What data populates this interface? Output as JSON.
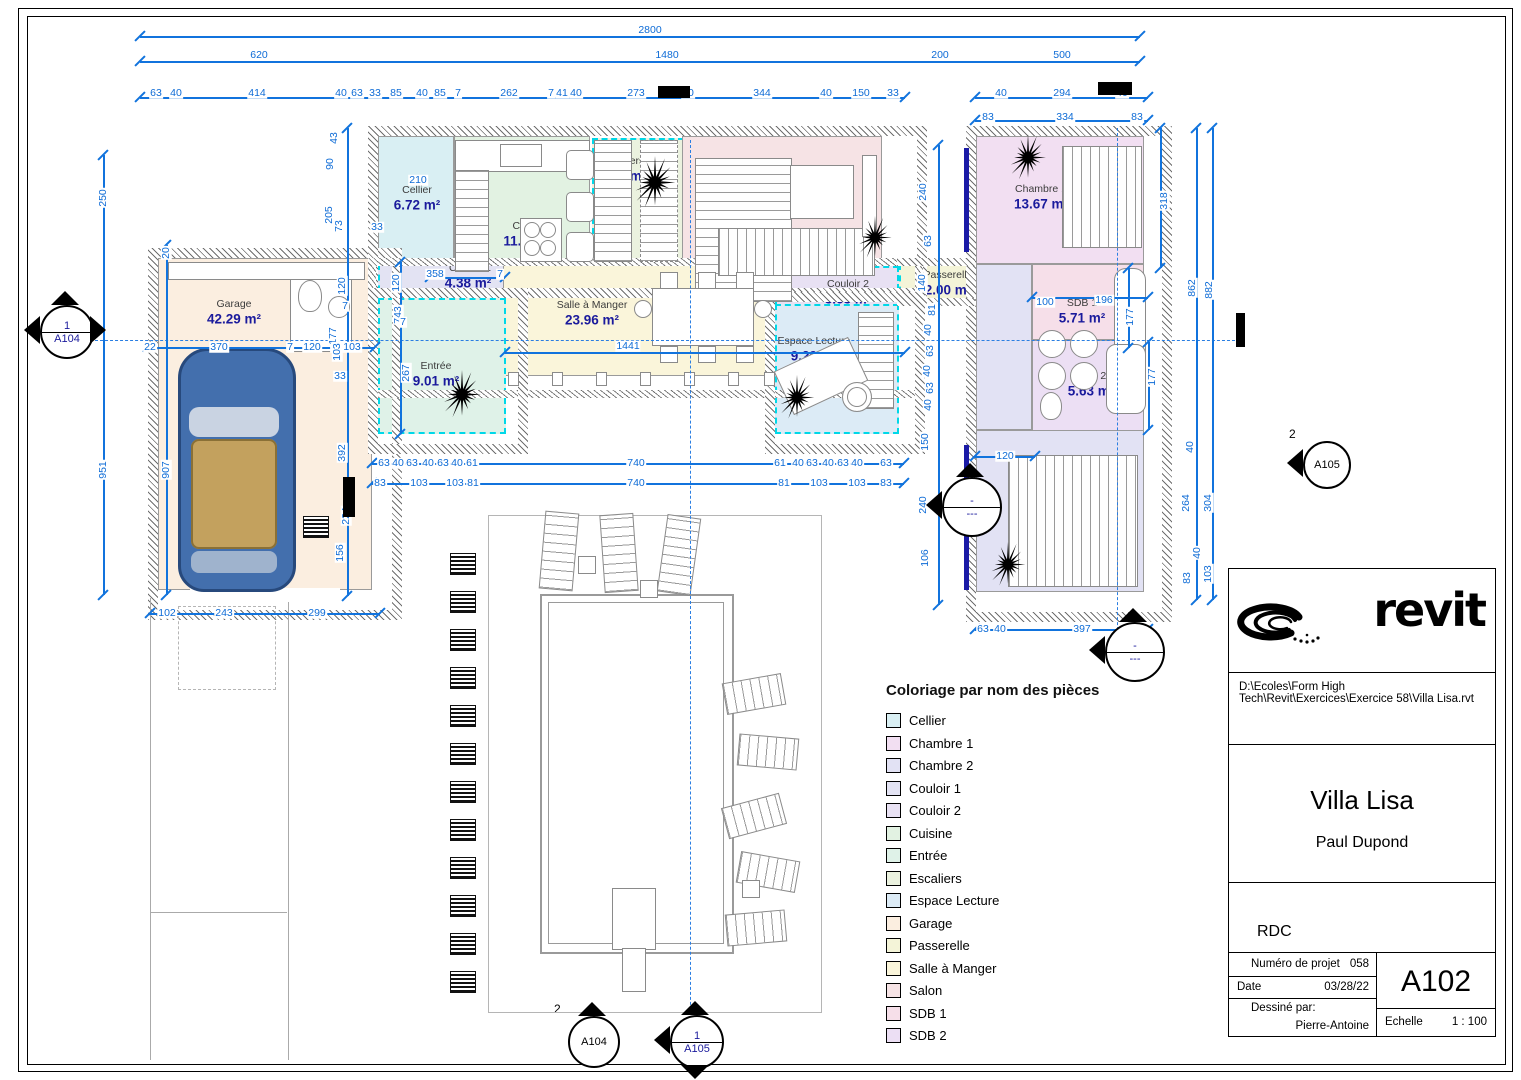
{
  "title_block": {
    "logo_text": "revit",
    "file_path": "D:\\Ecoles\\Form High Tech\\Revit\\Exercices\\Exercice 58\\Villa Lisa.rvt",
    "project_name": "Villa Lisa",
    "author": "Paul Dupond",
    "view_name": "RDC",
    "project_number_label": "Numéro de projet",
    "project_number": "058",
    "date_label": "Date",
    "date": "03/28/22",
    "drawn_by_label": "Dessiné par:",
    "drawn_by": "Pierre-Antoine",
    "sheet_number": "A102",
    "scale_label": "Echelle",
    "scale_value": "1 : 100"
  },
  "legend": {
    "title": "Coloriage par nom des pièces",
    "items": [
      {
        "label": "Cellier",
        "color": "#d9eff3"
      },
      {
        "label": "Chambre 1",
        "color": "#f2dff2"
      },
      {
        "label": "Chambre 2",
        "color": "#e2e2f4"
      },
      {
        "label": "Couloir 1",
        "color": "#e3e3f3"
      },
      {
        "label": "Couloir 2",
        "color": "#e8e1f3"
      },
      {
        "label": "Cuisine",
        "color": "#e2f2e2"
      },
      {
        "label": "Entrée",
        "color": "#dff2e8"
      },
      {
        "label": "Escaliers",
        "color": "#ebf2df"
      },
      {
        "label": "Espace Lecture",
        "color": "#dcebf6"
      },
      {
        "label": "Garage",
        "color": "#fbeee0"
      },
      {
        "label": "Passerelle",
        "color": "#f4f4d8"
      },
      {
        "label": "Salle à Manger",
        "color": "#faf5da"
      },
      {
        "label": "Salon",
        "color": "#f6e3e5"
      },
      {
        "label": "SDB 1",
        "color": "#f6dfe9"
      },
      {
        "label": "SDB 2",
        "color": "#ecdff4"
      }
    ]
  },
  "plan": {
    "haut_label": "HAUT",
    "rooms": [
      {
        "name": "Garage",
        "area": "42.29 m²",
        "color": "#fbeee0",
        "dashed": false
      },
      {
        "name": "Cellier",
        "area": "6.72 m²",
        "color": "#d9eff3",
        "dashed": false
      },
      {
        "name": "Cuisine",
        "area": "11.67 m²",
        "color": "#e2f2e2",
        "dashed": false
      },
      {
        "name": "Escaliers",
        "area": "8.03 m²",
        "color": "#ebf2df",
        "dashed": true
      },
      {
        "name": "Salon",
        "area": "20.39 m²",
        "color": "#f6e3e5",
        "dashed": false
      },
      {
        "name": "Couloir 1",
        "area": "4.38 m²",
        "color": "#e3e3f3",
        "dashed": true
      },
      {
        "name": "Salle à Manger",
        "area": "23.96 m²",
        "color": "#faf5da",
        "dashed": false
      },
      {
        "name": "Couloir 2",
        "area": "3.63 m²",
        "color": "#e8e1f3",
        "dashed": true
      },
      {
        "name": "Espace Lecture",
        "area": "9.29 m²",
        "color": "#dcebf6",
        "dashed": true
      },
      {
        "name": "Entrée",
        "area": "9.01 m²",
        "color": "#dff2e8",
        "dashed": true
      },
      {
        "name": "Passerelle",
        "area": "2.00 m²",
        "color": "#f4f4d8",
        "dashed": true
      },
      {
        "name": "Chambre 1",
        "area": "13.67 m²",
        "color": "#f2dff2",
        "dashed": false
      },
      {
        "name": "SDB 1",
        "area": "5.71 m²",
        "color": "#f6dfe9",
        "dashed": false
      },
      {
        "name": "SDB 2",
        "area": "5.63 m²",
        "color": "#ecdff4",
        "dashed": false
      },
      {
        "name": "Chambre 2",
        "area": "21.94 m²",
        "color": "#e2e2f4",
        "dashed": false
      }
    ],
    "dims": [
      [
        "2800",
        650,
        30,
        0
      ],
      [
        "620",
        259,
        55,
        0
      ],
      [
        "1480",
        667,
        55,
        0
      ],
      [
        "200",
        940,
        55,
        0
      ],
      [
        "500",
        1062,
        55,
        0
      ],
      [
        "63",
        156,
        93,
        0
      ],
      [
        "40",
        176,
        93,
        0
      ],
      [
        "414",
        257,
        93,
        0
      ],
      [
        "40",
        341,
        93,
        0
      ],
      [
        "63",
        357,
        93,
        0
      ],
      [
        "33",
        375,
        93,
        0
      ],
      [
        "85",
        396,
        93,
        0
      ],
      [
        "40",
        422,
        93,
        0
      ],
      [
        "85",
        440,
        93,
        0
      ],
      [
        "7",
        458,
        93,
        0
      ],
      [
        "262",
        509,
        93,
        0
      ],
      [
        "7",
        551,
        93,
        0
      ],
      [
        "41",
        562,
        93,
        0
      ],
      [
        "40",
        576,
        93,
        0
      ],
      [
        "273",
        636,
        93,
        0
      ],
      [
        "40",
        688,
        93,
        0
      ],
      [
        "344",
        762,
        93,
        0
      ],
      [
        "40",
        826,
        93,
        0
      ],
      [
        "150",
        861,
        93,
        0
      ],
      [
        "33",
        893,
        93,
        0
      ],
      [
        "40",
        1001,
        93,
        0
      ],
      [
        "294",
        1062,
        93,
        0
      ],
      [
        "40",
        1122,
        93,
        0
      ],
      [
        "83",
        988,
        117,
        0
      ],
      [
        "334",
        1065,
        117,
        0
      ],
      [
        "83",
        1137,
        117,
        0
      ],
      [
        "250",
        103,
        198,
        1
      ],
      [
        "951",
        103,
        470,
        1
      ],
      [
        "20",
        166,
        253,
        1
      ],
      [
        "907",
        166,
        470,
        1
      ],
      [
        "22",
        150,
        347,
        0
      ],
      [
        "370",
        219,
        347,
        0
      ],
      [
        "7",
        290,
        347,
        0
      ],
      [
        "120",
        312,
        347,
        0
      ],
      [
        "7",
        334,
        347,
        0
      ],
      [
        "103",
        352,
        347,
        0
      ],
      [
        "102",
        167,
        613,
        0
      ],
      [
        "243",
        224,
        613,
        0
      ],
      [
        "299",
        317,
        613,
        0
      ],
      [
        "43",
        334,
        138,
        1
      ],
      [
        "90",
        330,
        164,
        1
      ],
      [
        "205",
        329,
        215,
        1
      ],
      [
        "73",
        339,
        226,
        1
      ],
      [
        "33",
        377,
        227,
        0
      ],
      [
        "120",
        342,
        286,
        1
      ],
      [
        "120",
        396,
        283,
        1
      ],
      [
        "7",
        345,
        306,
        0
      ],
      [
        "743",
        398,
        315,
        1
      ],
      [
        "7",
        403,
        322,
        0
      ],
      [
        "177",
        333,
        336,
        1
      ],
      [
        "103",
        337,
        352,
        1
      ],
      [
        "33",
        340,
        376,
        0
      ],
      [
        "267",
        406,
        373,
        1
      ],
      [
        "392",
        342,
        453,
        1
      ],
      [
        "224",
        346,
        516,
        1
      ],
      [
        "156",
        340,
        553,
        1
      ],
      [
        "210",
        418,
        180,
        0
      ],
      [
        "358",
        435,
        274,
        0
      ],
      [
        "7",
        500,
        274,
        0
      ],
      [
        "1441",
        628,
        346,
        0
      ],
      [
        "63",
        384,
        463,
        0
      ],
      [
        "40",
        398,
        463,
        0
      ],
      [
        "63",
        412,
        463,
        0
      ],
      [
        "40",
        428,
        463,
        0
      ],
      [
        "63",
        443,
        463,
        0
      ],
      [
        "40",
        457,
        463,
        0
      ],
      [
        "61",
        472,
        463,
        0
      ],
      [
        "740",
        636,
        463,
        0
      ],
      [
        "61",
        780,
        463,
        0
      ],
      [
        "40",
        798,
        463,
        0
      ],
      [
        "63",
        812,
        463,
        0
      ],
      [
        "40",
        828,
        463,
        0
      ],
      [
        "63",
        843,
        463,
        0
      ],
      [
        "40",
        857,
        463,
        0
      ],
      [
        "63",
        886,
        463,
        0
      ],
      [
        "83",
        380,
        483,
        0
      ],
      [
        "103",
        419,
        483,
        0
      ],
      [
        "103",
        455,
        483,
        0
      ],
      [
        "81",
        473,
        483,
        0
      ],
      [
        "740",
        636,
        483,
        0
      ],
      [
        "81",
        784,
        483,
        0
      ],
      [
        "103",
        819,
        483,
        0
      ],
      [
        "103",
        857,
        483,
        0
      ],
      [
        "83",
        886,
        483,
        0
      ],
      [
        "240",
        923,
        192,
        1
      ],
      [
        "63",
        928,
        241,
        1
      ],
      [
        "140",
        922,
        283,
        1
      ],
      [
        "81",
        932,
        310,
        1
      ],
      [
        "40",
        928,
        330,
        1
      ],
      [
        "63",
        930,
        351,
        1
      ],
      [
        "40",
        927,
        371,
        1
      ],
      [
        "63",
        930,
        388,
        1
      ],
      [
        "40",
        928,
        405,
        1
      ],
      [
        "150",
        925,
        442,
        1
      ],
      [
        "240",
        923,
        505,
        1
      ],
      [
        "106",
        925,
        558,
        1
      ],
      [
        "318",
        1164,
        201,
        1
      ],
      [
        "862",
        1192,
        288,
        1
      ],
      [
        "882",
        1209,
        290,
        1
      ],
      [
        "100",
        1045,
        302,
        0
      ],
      [
        "196",
        1104,
        300,
        0
      ],
      [
        "177",
        1130,
        317,
        1
      ],
      [
        "177",
        1152,
        377,
        1
      ],
      [
        "120",
        1005,
        456,
        0
      ],
      [
        "40",
        1190,
        447,
        1
      ],
      [
        "264",
        1186,
        503,
        1
      ],
      [
        "304",
        1208,
        503,
        1
      ],
      [
        "40",
        1197,
        553,
        1
      ],
      [
        "83",
        1187,
        578,
        1
      ],
      [
        "103",
        1208,
        574,
        1
      ],
      [
        "63",
        983,
        629,
        0
      ],
      [
        "40",
        1000,
        629,
        0
      ],
      [
        "397",
        1082,
        629,
        0
      ]
    ],
    "markers": [
      {
        "top": "1",
        "bottom": "A104",
        "x": 65,
        "y": 330,
        "r": 25,
        "color": "#1a1a9c",
        "tris": [
          "up",
          "left",
          "right"
        ]
      },
      {
        "top": "2",
        "bottom": "A104",
        "x": 592,
        "y": 1040,
        "r": 24,
        "color": "#000000",
        "tris": [
          "up"
        ],
        "num_outside": true
      },
      {
        "top": "1",
        "bottom": "A105",
        "x": 695,
        "y": 1040,
        "r": 25,
        "color": "#1a1a9c",
        "tris": [
          "left",
          "up",
          "down"
        ]
      },
      {
        "top": "2",
        "bottom": "A105",
        "x": 1325,
        "y": 463,
        "r": 22,
        "color": "#000000",
        "tris": [
          "left"
        ],
        "num_outside": true
      },
      {
        "top": "-",
        "bottom": "---",
        "x": 970,
        "y": 505,
        "r": 28,
        "color": "#1a1a9c",
        "tris": [
          "up",
          "left"
        ]
      },
      {
        "top": "-",
        "bottom": "---",
        "x": 1133,
        "y": 650,
        "r": 28,
        "color": "#1a1a9c",
        "tris": [
          "up",
          "left"
        ]
      }
    ]
  }
}
